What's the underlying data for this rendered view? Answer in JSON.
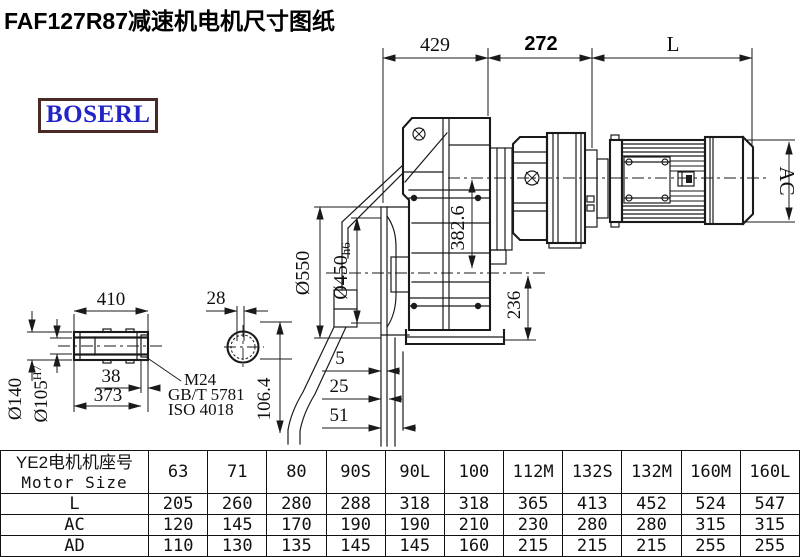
{
  "title": "FAF127R87减速机电机尺寸图纸",
  "logo": {
    "text": "BOSERL"
  },
  "colors": {
    "line": "#1a1a1a",
    "logo_text": "#2224c8",
    "logo_border": "#4b2a26",
    "background": "#ffffff"
  },
  "drawing": {
    "dim_429": "429",
    "dim_272": "272",
    "dim_L": "L",
    "dim_550": "Ø550",
    "dim_450": "Ø450",
    "dim_450_tol": "h6",
    "dim_382": "382.6",
    "dim_236": "236",
    "dim_AC": "AC",
    "dim_5": "5",
    "dim_25": "25",
    "dim_51": "51",
    "dim_410": "410",
    "dim_140": "Ø140",
    "dim_105": "Ø105",
    "dim_105_tol": "H7",
    "dim_38": "38",
    "dim_373": "373",
    "leader_m24": "M24",
    "leader_gbt": "GB/T 5781",
    "leader_iso": "ISO 4018",
    "dim_28": "28",
    "dim_106": "106.4"
  },
  "table": {
    "header_cn": "YE2电机机座号",
    "header_en": "Motor Size",
    "columns": [
      "63",
      "71",
      "80",
      "90S",
      "90L",
      "100",
      "112M",
      "132S",
      "132M",
      "160M",
      "160L"
    ],
    "rows": [
      {
        "label": "L",
        "values": [
          "205",
          "260",
          "280",
          "288",
          "318",
          "318",
          "365",
          "413",
          "452",
          "524",
          "547"
        ]
      },
      {
        "label": "AC",
        "values": [
          "120",
          "145",
          "170",
          "190",
          "190",
          "210",
          "230",
          "280",
          "280",
          "315",
          "315"
        ]
      },
      {
        "label": "AD",
        "values": [
          "110",
          "130",
          "135",
          "145",
          "145",
          "160",
          "215",
          "215",
          "215",
          "255",
          "255"
        ]
      }
    ]
  }
}
